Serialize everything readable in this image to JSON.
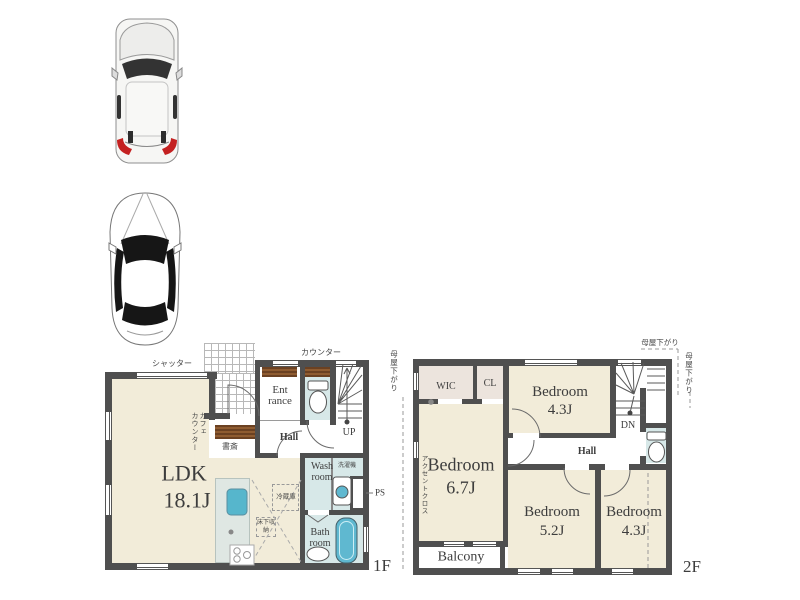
{
  "floor1": {
    "label": "1F",
    "shutter": "シャッター",
    "counter": "カウンター",
    "cafe_counter_1": "カフェ",
    "cafe_counter_2": "カウンター",
    "study": "書斎",
    "ldk": "LDK",
    "ldk_size": "18.1J",
    "entrance_1": "Ent",
    "entrance_2": "rance",
    "hall": "Hall",
    "up": "UP",
    "wash_1": "Wash",
    "wash_2": "room",
    "washer": "洗濯機",
    "ps": "PS",
    "fridge": "冷蔵庫",
    "floor_storage": "床下収納",
    "bath_1": "Bath",
    "bath_2": "room"
  },
  "floor2": {
    "label": "2F",
    "moya_top": "母屋下がり",
    "moya_right": "母屋下がり",
    "moya_left": "母屋下がり",
    "wic": "WIC",
    "cl": "CL",
    "bedroom_a": "Bedroom",
    "bedroom_a_size": "4.3J",
    "bedroom_b": "Bedroom",
    "bedroom_b_size": "6.7J",
    "bedroom_c": "Bedroom",
    "bedroom_c_size": "5.2J",
    "bedroom_d": "Bedroom",
    "bedroom_d_size": "4.3J",
    "hall": "Hall",
    "dn": "DN",
    "balcony": "Balcony",
    "accent_cloth": "アクセントクロス"
  },
  "icons": {
    "car_1": "car-suv-top-view",
    "car_2": "car-sedan-top-view",
    "toilet": "toilet",
    "bathtub": "bathtub",
    "washing_machine": "washing-machine",
    "kitchen_sink": "kitchen-sink",
    "stove": "stove"
  },
  "colors": {
    "wall": "#4f4f4f",
    "floor_beige": "#f2ecd9",
    "floor_wet": "#d7e8e8",
    "floor_closet": "#ece4dd",
    "counter_brown": "#7a4e28",
    "fixture_blue": "#5fb8d0",
    "kitchen_counter": "#dfe7e3",
    "line_grey": "#999999"
  }
}
